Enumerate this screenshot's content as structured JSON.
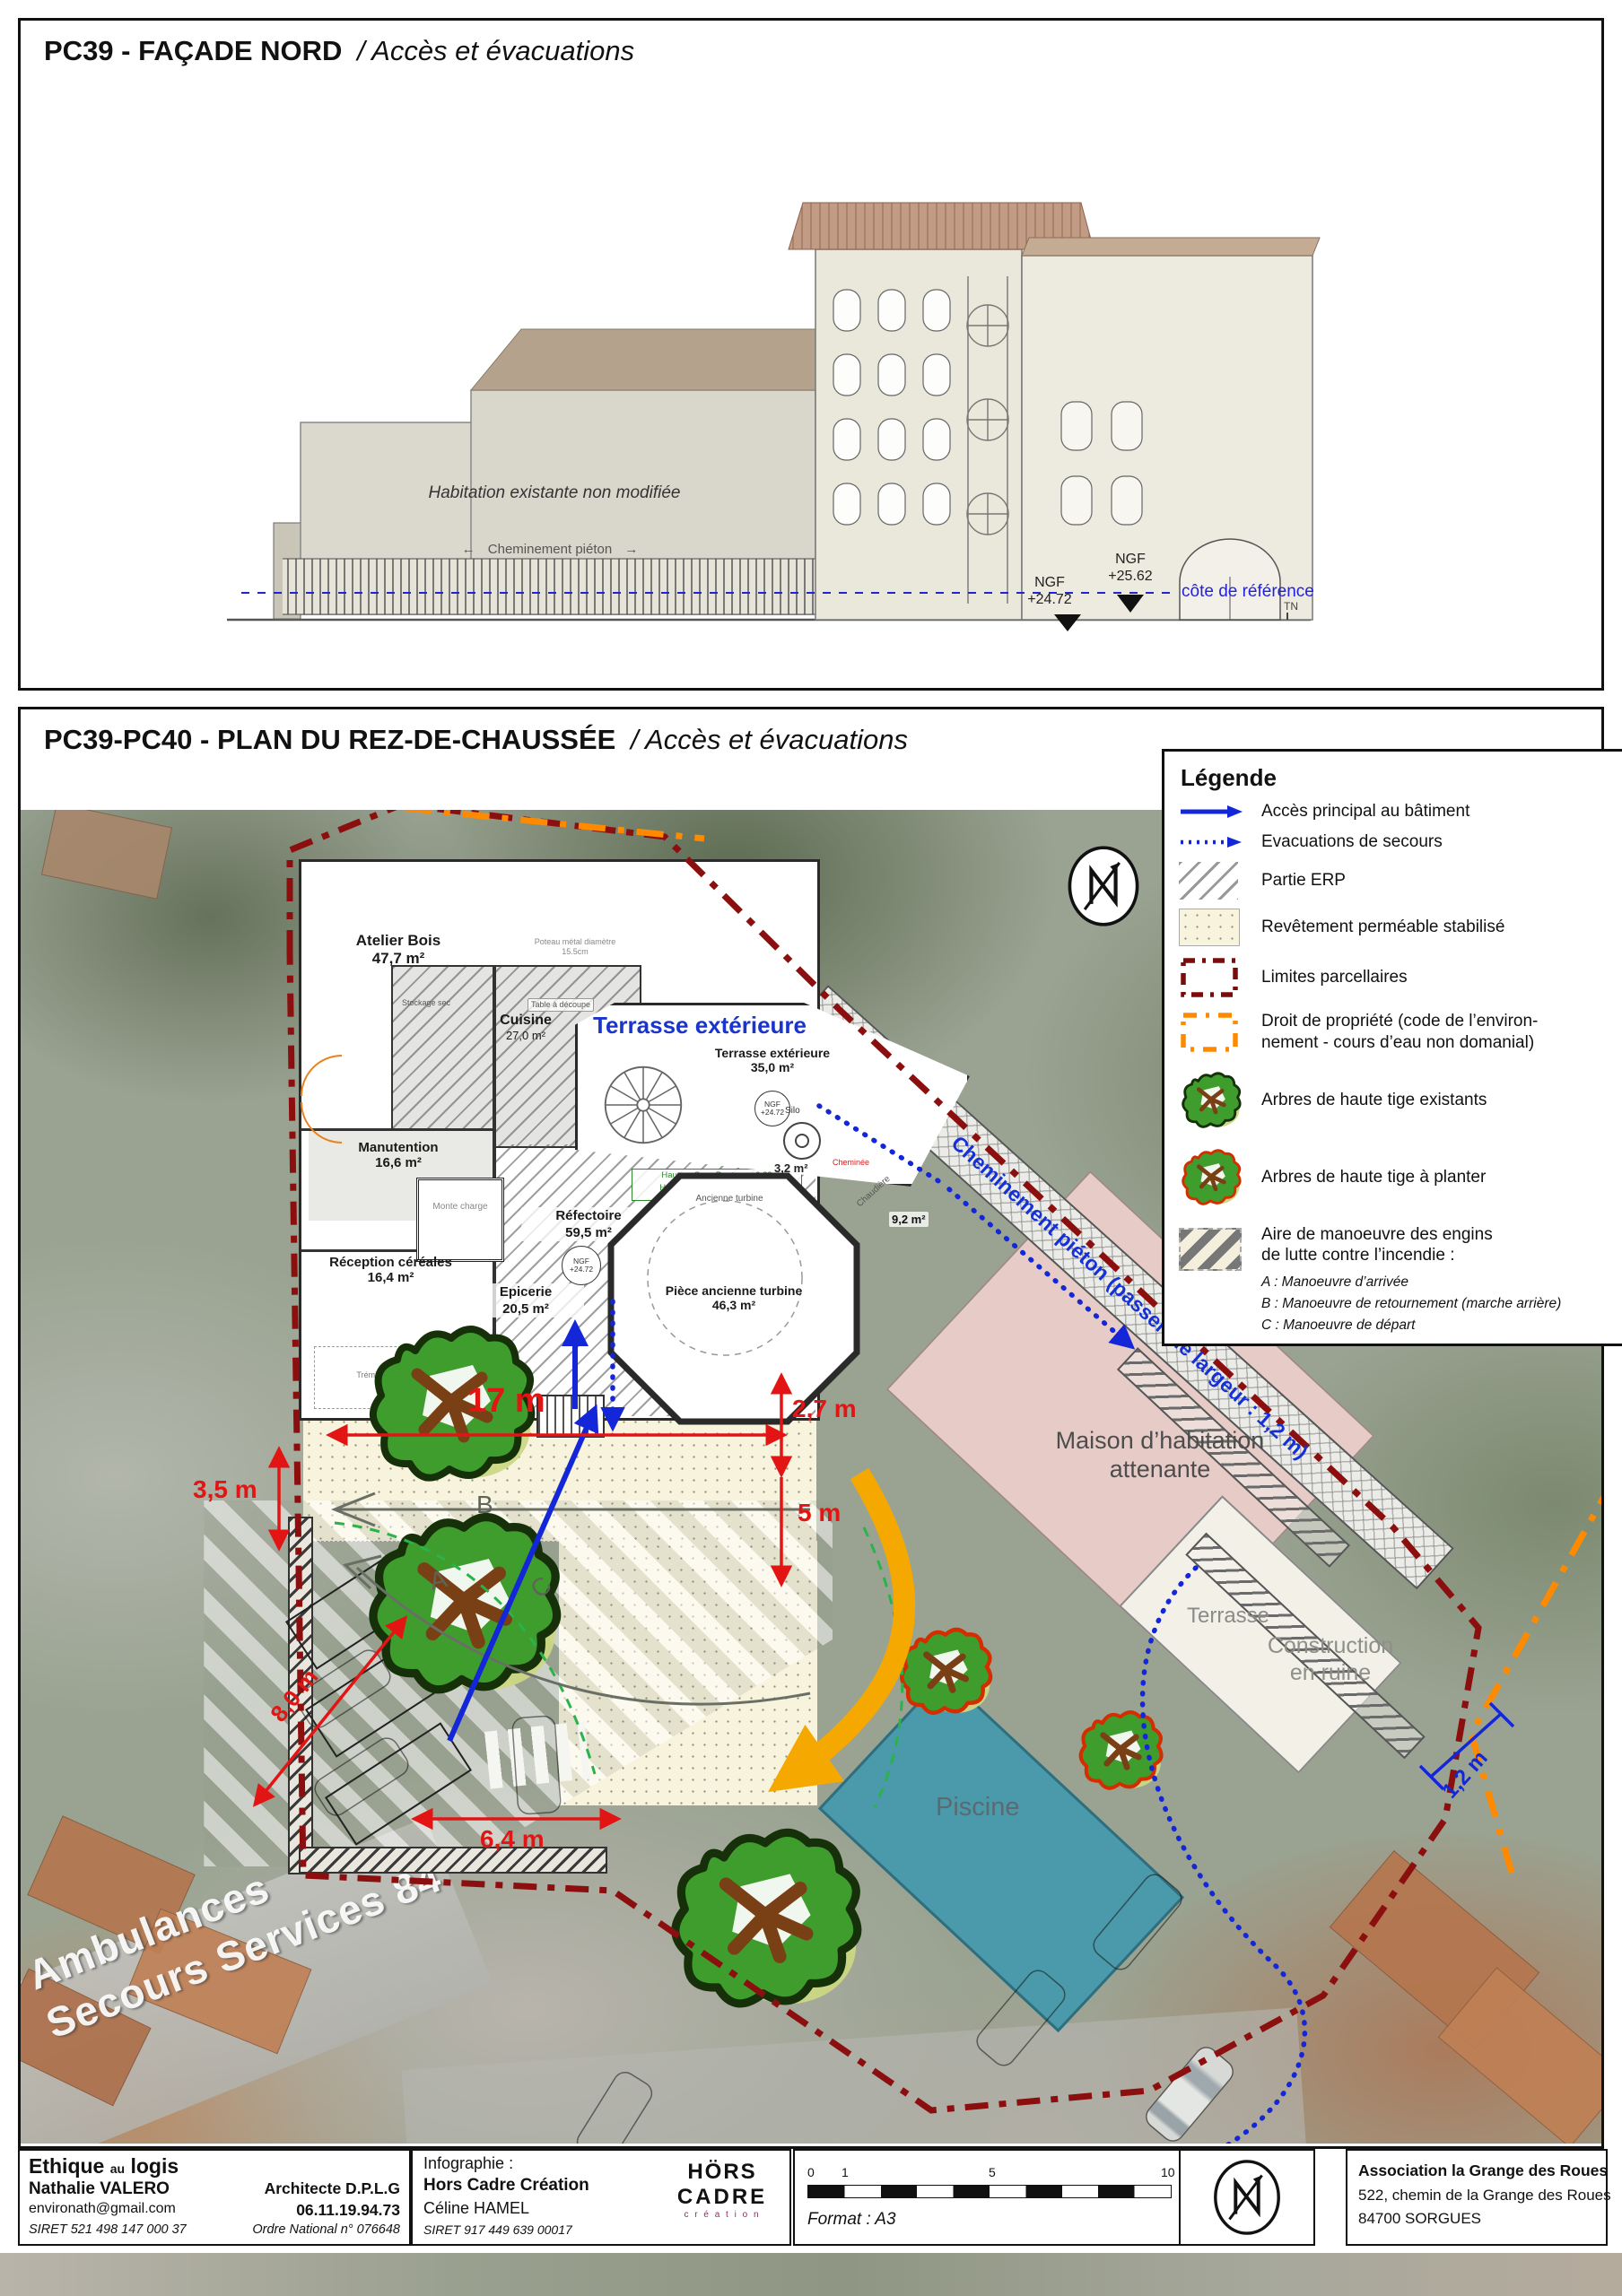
{
  "colors": {
    "accent_blue": "#1326d8",
    "dim_red": "#e31414",
    "parcel_red": "#8c0f0f",
    "property_orange": "#ff8a00",
    "pool_teal": "#4b9aab",
    "maison_pink": "#e7cbc7",
    "stipple_beige": "#f8f3dc"
  },
  "facade": {
    "title_main": "PC39 - FAÇADE NORD",
    "title_sub": "/ Accès et évacuations",
    "habitation": "Habitation existante non modifiée",
    "walkway": "Cheminement piéton",
    "arrow_left": "←",
    "arrow_right": "→",
    "ngf_high_1": "NGF",
    "ngf_high_2": "+25.62",
    "ngf_low_1": "NGF",
    "ngf_low_2": "+24.72",
    "cote": "côte de référence",
    "tn": "TN"
  },
  "plan": {
    "title_main": "PC39-PC40 - PLAN DU REZ-DE-CHAUSSÉE",
    "title_sub": "/ Accès et évacuations",
    "legend": {
      "title": "Légende",
      "items": [
        {
          "label": "Accès principal au bâtiment"
        },
        {
          "label": "Evacuations de secours"
        },
        {
          "label": "Partie ERP"
        },
        {
          "label": "Revêtement perméable stabilisé"
        },
        {
          "label": "Limites parcellaires"
        },
        {
          "label": "Droit de propriété (code de l’environ-",
          "label2": "nement - cours d’eau non domanial)"
        },
        {
          "label": "Arbres de haute tige existants"
        },
        {
          "label": "Arbres de haute tige à planter"
        },
        {
          "label": "Aire de manoeuvre des engins",
          "label2": "de lutte contre l’incendie :",
          "sub": [
            "A : Manoeuvre d’arrivée",
            "B : Manoeuvre de retournement (marche arrière)",
            "C : Manoeuvre de départ"
          ]
        }
      ]
    },
    "rooms": {
      "atelier": {
        "name": "Atelier Bois",
        "area": "47,7 m²"
      },
      "cuisine": {
        "name": "Cuisine",
        "area": "27,0 m²"
      },
      "manutention": {
        "name": "Manutention",
        "area": "16,6 m²"
      },
      "reception": {
        "name": "Réception céréales",
        "area": "16,4 m²"
      },
      "epicerie": {
        "name": "Epicerie",
        "area": "20,5 m²"
      },
      "refectoire": {
        "name": "Réfectoire",
        "area": "59,5 m²"
      },
      "turbine": {
        "name": "Pièce ancienne turbine",
        "area": "46,3 m²"
      },
      "terrasse": {
        "name": "Terrasse extérieure",
        "area": "35,0 m²"
      },
      "silo": {
        "name": "Silo",
        "area": "3,2 m²"
      },
      "chaufferie": {
        "area": "9,2 m²"
      }
    },
    "labels": {
      "terrace_heading": "Terrasse extérieure",
      "maison_1": "Maison d’habitation",
      "maison_2": "attenante",
      "terrasse": "Terrasse",
      "ruine_1": "Construction",
      "ruine_2": "en ruine",
      "piscine": "Piscine",
      "walkway": "Cheminement piéton (passerelle largeur : 1,2 m)",
      "watermark_1": "Ambulances",
      "watermark_2": "Secours Services 84",
      "ancienne_turbine": "Ancienne turbine",
      "monte_charge": "Monte charge",
      "tremie": "Trémie blé",
      "stockage": "Stockage sec",
      "table_decoupe": "Table à découpe",
      "chaudiere": "Chaudière",
      "cheminee": "Cheminée",
      "poteau_1": "Poteau métal diamètre",
      "poteau_2": "15.5cm",
      "hsp_1": "Hauteur Sous Poutre : + 2.89",
      "hsp_2": "Hauteur sous plancher : +3.27",
      "ngf_1": "NGF",
      "ngf_2": "+24.72"
    },
    "dims": {
      "d17": "17 m",
      "d27": "2,7 m",
      "d5": "5 m",
      "d35": "3,5 m",
      "d80": "8,0 m",
      "d64": "6,4 m",
      "d12": "1,2 m"
    },
    "letters": {
      "a": "A",
      "b": "B",
      "c": "C"
    }
  },
  "footer": {
    "firm_1": "Ethique",
    "firm_2": "au",
    "firm_3": "logis",
    "architect": "Nathalie  VALERO",
    "email": "environath@gmail.com",
    "siret_1": "SIRET  521 498 147 000 37",
    "title": "Architecte D.P.L.G",
    "phone": "06.11.19.94.73",
    "ordre": "Ordre National  n° 076648",
    "infographie": "Infographie :",
    "studio": "Hors Cadre Création",
    "designer": "Céline HAMEL",
    "siret_2": "SIRET 917 449 639 00017",
    "logo_1": "HÖRS",
    "logo_2": "CADRE",
    "logo_3": "c r é a t i o n",
    "scale": [
      "0",
      "1",
      "5",
      "10 m"
    ],
    "format": "Format : A3",
    "assoc_1": "Association la Grange des Roues",
    "assoc_2": "522, chemin de la Grange des Roues",
    "assoc_3": "84700 SORGUES"
  }
}
